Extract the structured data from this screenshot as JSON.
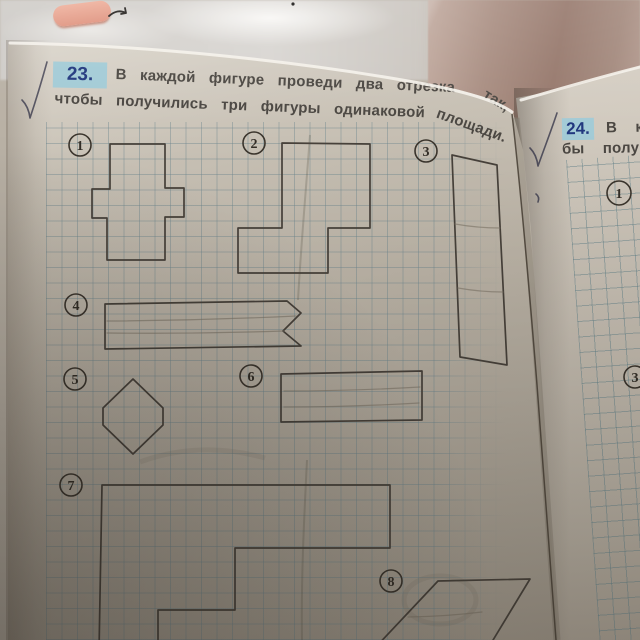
{
  "task23": {
    "number": "23.",
    "line1_main": "В каждой фигуре проведи два отрезка",
    "line1_tail": "так,",
    "line2_main": "чтобы получились три фигуры одинаковой",
    "line2_tail": "площади."
  },
  "task24": {
    "number": "24.",
    "line1_fragment": "В к",
    "line2_fragment": "бы полу"
  },
  "colors": {
    "task_highlight": "#a3cbd6",
    "task_number_ink": "#21377e",
    "body_text_ink": "#4b4742",
    "figure_ink": "#47413a",
    "pencil_mark": "#7c7365",
    "grid_line": "#68838c",
    "paper": "#bcb4a7"
  },
  "figures": [
    {
      "label": "1",
      "shape": "cross",
      "label_x": 80,
      "label_y": 145,
      "points": [
        [
          110,
          144
        ],
        [
          165,
          144
        ],
        [
          165,
          188
        ],
        [
          184,
          188
        ],
        [
          184,
          217
        ],
        [
          165,
          217
        ],
        [
          165,
          260
        ],
        [
          107,
          260
        ],
        [
          107,
          218
        ],
        [
          92,
          218
        ],
        [
          92,
          189
        ],
        [
          110,
          189
        ]
      ]
    },
    {
      "label": "2",
      "shape": "step-block",
      "label_x": 254,
      "label_y": 143,
      "points": [
        [
          282,
          143
        ],
        [
          370,
          144
        ],
        [
          370,
          228
        ],
        [
          328,
          228
        ],
        [
          328,
          273
        ],
        [
          238,
          273
        ],
        [
          238,
          228
        ],
        [
          282,
          228
        ]
      ]
    },
    {
      "label": "3",
      "shape": "tall-rectangle",
      "label_x": 426,
      "label_y": 151,
      "points": [
        [
          452,
          155
        ],
        [
          497,
          165
        ],
        [
          507,
          365
        ],
        [
          460,
          357
        ]
      ],
      "pencil": [
        [
          [
            455,
            224
          ],
          [
            500,
            228
          ]
        ],
        [
          [
            458,
            288
          ],
          [
            503,
            292
          ]
        ]
      ]
    },
    {
      "label": "4",
      "shape": "notched-strip",
      "label_x": 76,
      "label_y": 305,
      "points": [
        [
          105,
          304
        ],
        [
          287,
          301
        ],
        [
          301,
          313
        ],
        [
          283,
          331
        ],
        [
          301,
          346
        ],
        [
          105,
          349
        ]
      ],
      "pencil": [
        [
          [
            107,
            321
          ],
          [
            296,
            316
          ]
        ],
        [
          [
            107,
            333
          ],
          [
            284,
            331
          ]
        ]
      ]
    },
    {
      "label": "5",
      "shape": "hexagon",
      "label_x": 75,
      "label_y": 379,
      "points": [
        [
          133,
          379
        ],
        [
          163,
          408
        ],
        [
          163,
          425
        ],
        [
          133,
          454
        ],
        [
          103,
          425
        ],
        [
          103,
          408
        ]
      ]
    },
    {
      "label": "6",
      "shape": "rectangle",
      "label_x": 251,
      "label_y": 376,
      "points": [
        [
          281,
          374
        ],
        [
          422,
          371
        ],
        [
          422,
          420
        ],
        [
          281,
          422
        ]
      ],
      "pencil": [
        [
          [
            284,
            391
          ],
          [
            420,
            387
          ]
        ],
        [
          [
            284,
            407
          ],
          [
            419,
            403
          ]
        ]
      ]
    },
    {
      "label": "7",
      "shape": "staircase",
      "label_x": 71,
      "label_y": 485,
      "points": [
        [
          102,
          485
        ],
        [
          390,
          485
        ],
        [
          390,
          548
        ],
        [
          235,
          548
        ],
        [
          235,
          610
        ],
        [
          158,
          610
        ],
        [
          158,
          652
        ],
        [
          99,
          652
        ]
      ]
    },
    {
      "label": "8",
      "shape": "parallelogram",
      "label_x": 391,
      "label_y": 581,
      "points": [
        [
          373,
          650
        ],
        [
          438,
          581
        ],
        [
          530,
          579
        ],
        [
          487,
          650
        ]
      ],
      "pencil": [
        [
          [
            408,
            617
          ],
          [
            482,
            612
          ]
        ]
      ]
    }
  ],
  "right_page_figure_labels": [
    {
      "label": "1",
      "x": 619,
      "y": 193,
      "r": 12
    },
    {
      "label": "3",
      "x": 635,
      "y": 377,
      "r": 11
    }
  ]
}
